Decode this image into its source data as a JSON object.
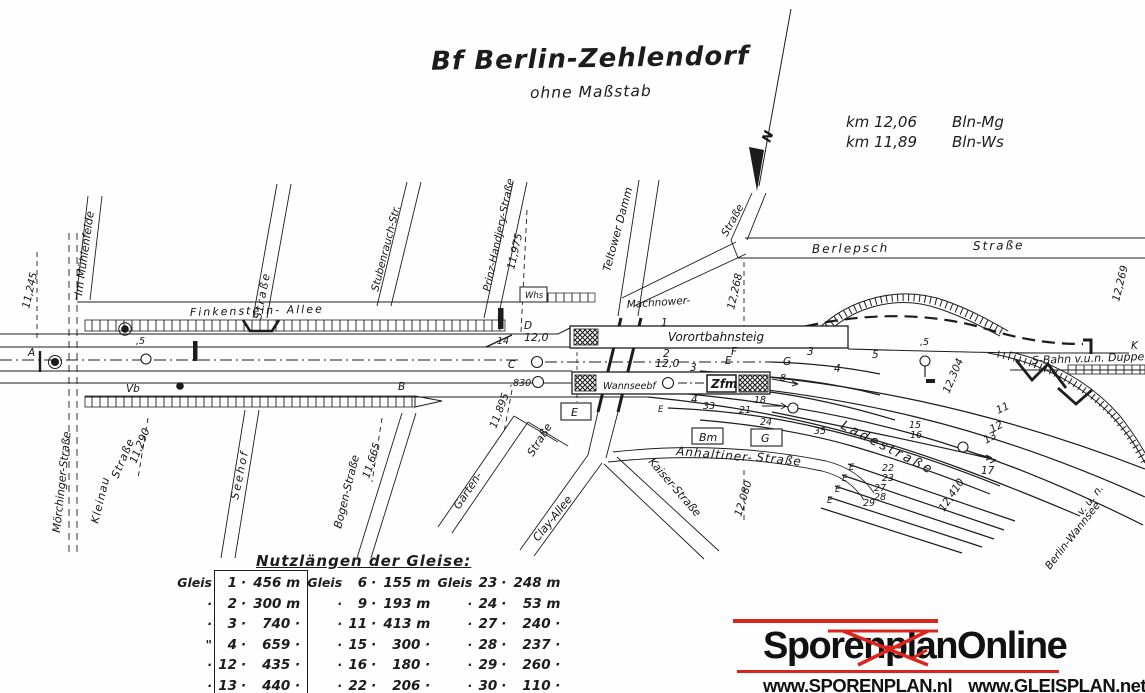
{
  "title": {
    "main": "Bf Berlin-Zehlendorf",
    "sub": "ohne Maßstab"
  },
  "legend": {
    "rows": [
      {
        "km": "km 12,06",
        "dest": "Bln-Mg"
      },
      {
        "km": "km 11,89",
        "dest": "Bln-Ws"
      }
    ]
  },
  "north": {
    "label": "N"
  },
  "streets": {
    "im_muehlenfelde": "Im Mühlenfelde",
    "moerchinger": "Mörchinger-Straße",
    "kleinau_1": "Kleinau",
    "kleinau_2": "Straße",
    "seehof_str": "Straße",
    "seehof": "Seehof",
    "finkenstein": "Finkenstein- Allee",
    "stubenrauch": "Stubenrauch-Str.",
    "prinz_handjery": "Prinz-Handjery-Straße",
    "teltower": "Teltower Damm",
    "str_ne": "Straße",
    "berlepsch_1": "Berlepsch",
    "berlepsch_2": "Straße",
    "machnower": "Machnower-",
    "bogen": "Bogen-Straße",
    "garten": "Garten-",
    "garten_str": "Straße",
    "clay": "Clay-Allee",
    "kaiser": "Kaiser-Straße",
    "anhaltiner_1": "Anhaltiner-",
    "anhaltiner_2": "Straße",
    "ladestrasse": "Ladestraße",
    "sbahn_dueppel": "S-Bahn v.u.n. Düppel",
    "wannsee_1": "v. u. n.",
    "wannsee_2": "Berlin-Wannsee"
  },
  "km": {
    "k11245": "11,245",
    "k11290": "11,290",
    "k11665": "11,665",
    "k11895": "11,895",
    "k11975": "11,975",
    "k12080": "12,080",
    "k12268": "12,268",
    "k12269": "12,269",
    "k12304": "12,304",
    "k12410": "12,410"
  },
  "labels": {
    "a": "A",
    "b": "B",
    "c": "C",
    "d": "D",
    "e": "E",
    "f": "F",
    "g": "G",
    "k": "K",
    "vb": "Vb",
    "e_marker": "E",
    "whs": "Whs",
    "zfm": "Zfm",
    "bm": "Bm",
    "g_box": "G",
    "e_box": "E",
    "vorortbahnsteig": "Vorortbahnsteig",
    "wannseebf": "Wannseebf",
    "t1": "1",
    "t2": "2",
    "t3": "3",
    "t4": "4",
    "t3e": "3",
    "t4e": "4",
    "t5": "5",
    "t11": "11",
    "t12": "12",
    "t13": "13",
    "t15": "15",
    "t16": "16",
    "t17": "17",
    "s22": "22",
    "s23": "23",
    "s27": "27",
    "s28": "28",
    "s29": "29",
    "n5w": ",5",
    "n5e": ",5",
    "n8": "8",
    "n14": "14",
    "n18": "18",
    "n21": "21",
    "n24": "24",
    "n33": "33",
    "n35": "35",
    "len_a": "12,0",
    "len_b": "12,0",
    "n830": ",830"
  },
  "table": {
    "title": "Nutzlängen der Gleise:",
    "sep": "·",
    "columns": [
      {
        "prefixes": [
          "Gleis",
          "·",
          "·",
          "\"",
          "·",
          "·"
        ],
        "rows": [
          {
            "n": "1",
            "v": "456 m"
          },
          {
            "n": "2",
            "v": "300 m"
          },
          {
            "n": "3",
            "v": "740 ·"
          },
          {
            "n": "4",
            "v": "659 ·"
          },
          {
            "n": "12",
            "v": "435 ·"
          },
          {
            "n": "13",
            "v": "440 ·"
          }
        ]
      },
      {
        "prefixes": [
          "Gleis",
          "·",
          "·",
          "·",
          "·",
          "·"
        ],
        "rows": [
          {
            "n": "6",
            "v": "155 m"
          },
          {
            "n": "9",
            "v": "193 m"
          },
          {
            "n": "11",
            "v": "413 m"
          },
          {
            "n": "15",
            "v": "300 ·"
          },
          {
            "n": "16",
            "v": "180 ·"
          },
          {
            "n": "22",
            "v": "206 ·"
          }
        ]
      },
      {
        "prefixes": [
          "Gleis",
          "·",
          "·",
          "·",
          "·",
          "·"
        ],
        "rows": [
          {
            "n": "23",
            "v": "248 m"
          },
          {
            "n": "24",
            "v": "53 m"
          },
          {
            "n": "27",
            "v": "240 ·"
          },
          {
            "n": "28",
            "v": "237 ·"
          },
          {
            "n": "29",
            "v": "260 ·"
          },
          {
            "n": "30",
            "v": "110 ·"
          }
        ]
      }
    ]
  },
  "logo": {
    "name": "SporenplanOnline",
    "url1": "www.SPORENPLAN.nl",
    "url2": "www.GLEISPLAN.net"
  },
  "colors": {
    "ink": "#1c1c1c",
    "paper": "#fefefe",
    "logo_red": "#d9251c"
  }
}
